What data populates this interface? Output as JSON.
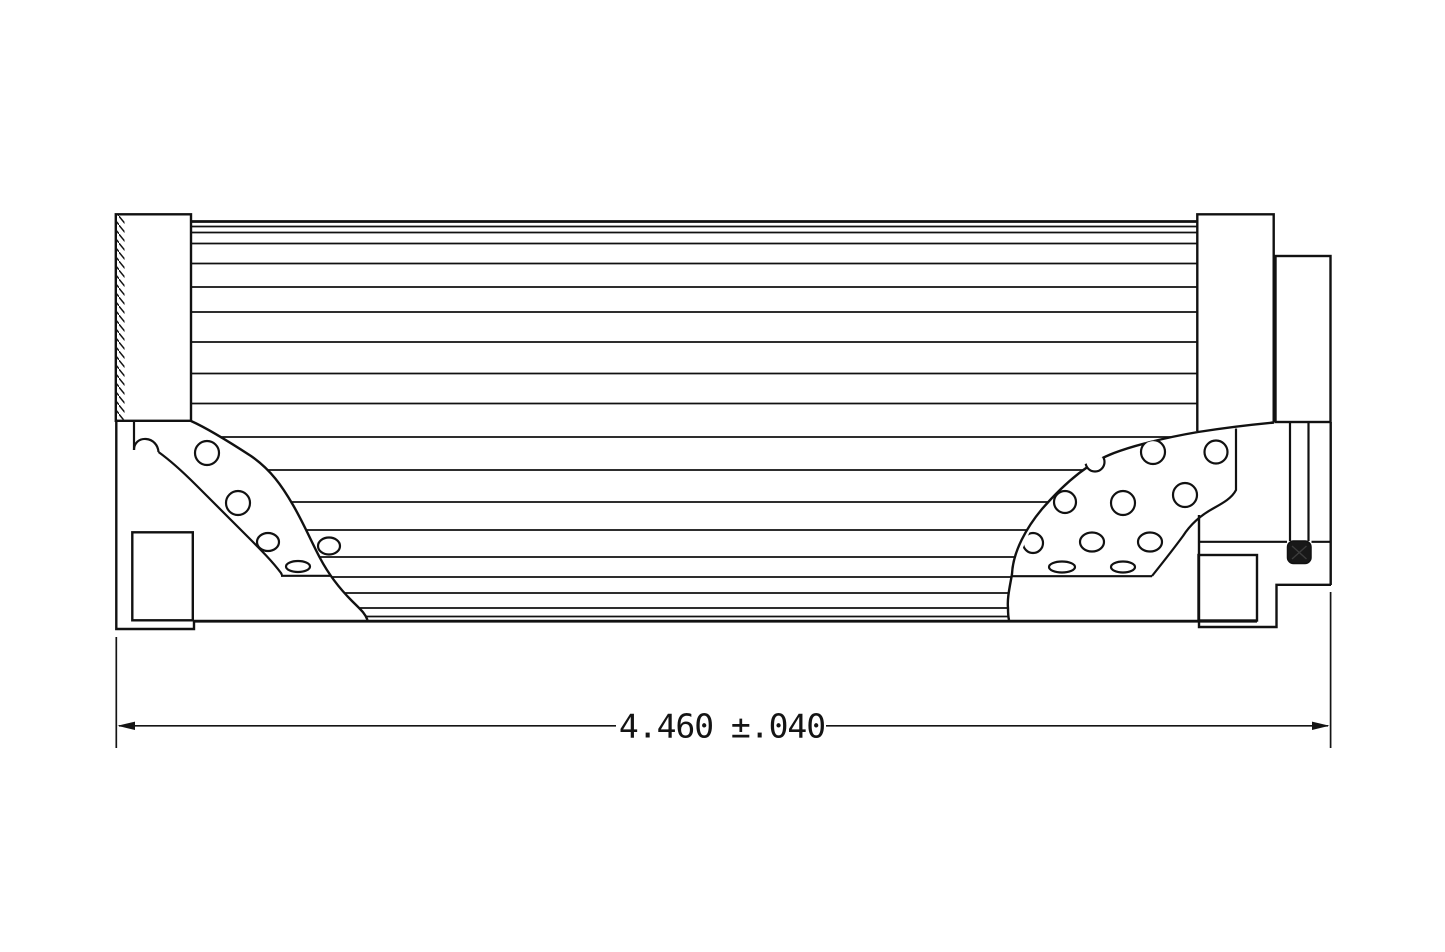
{
  "drawing": {
    "kind": "filter-element-cross-section",
    "dimension": {
      "value": "4.460",
      "tolerance": "±.040"
    },
    "colors": {
      "background": "#ffffff",
      "line": "#111111",
      "seal": "#181818"
    }
  }
}
